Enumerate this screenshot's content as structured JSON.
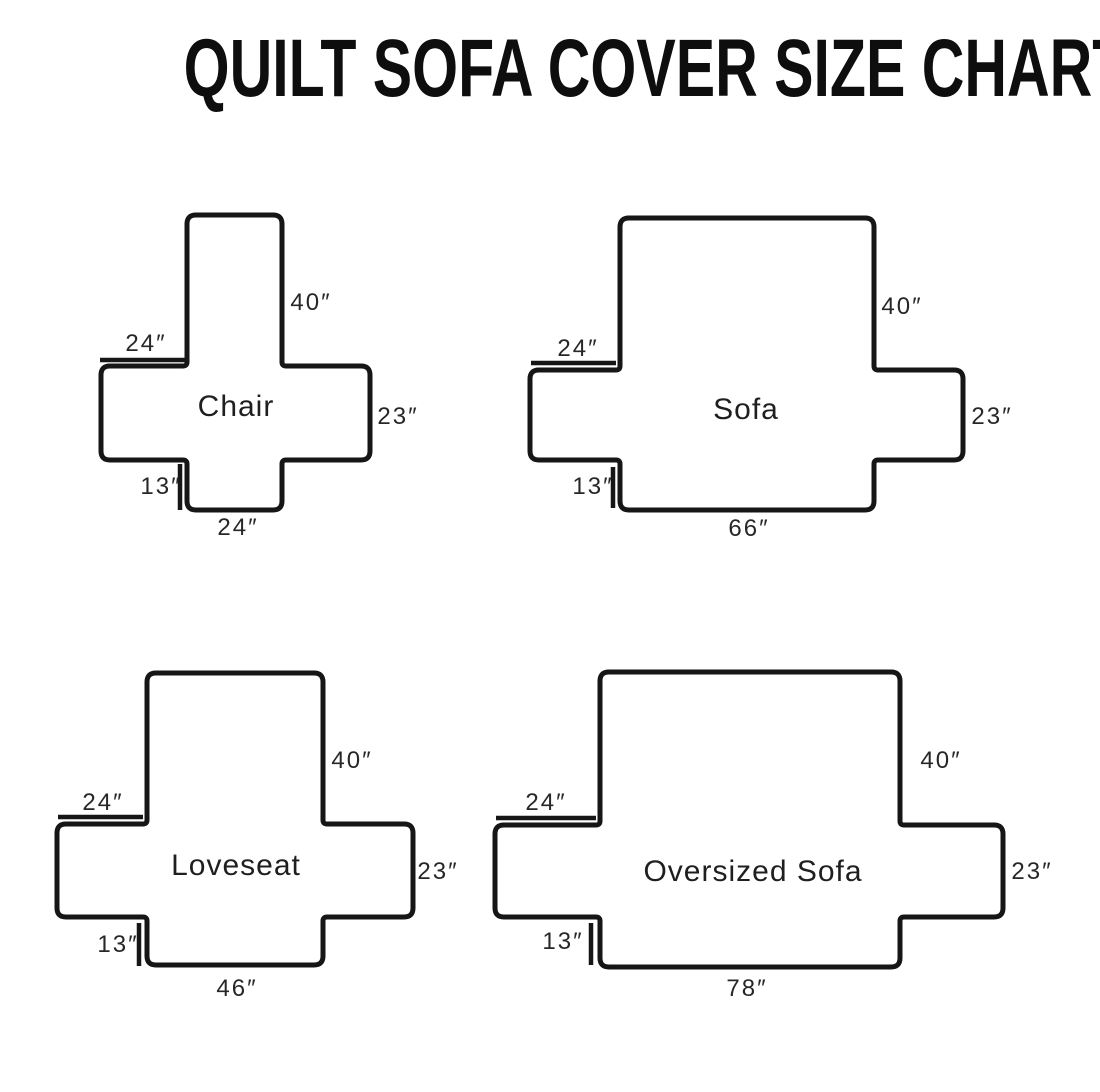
{
  "title": "QUILT SOFA COVER SIZE CHART",
  "colors": {
    "ink": "#161616",
    "label": "#272727",
    "background": "#ffffff"
  },
  "chart_data": {
    "type": "diagram",
    "description": "Cross-shaped quilted sofa cover templates with dimension labels",
    "items": [
      {
        "name": "Chair",
        "back_height_in": 40,
        "arm_width_in": 24,
        "side_height_in": 23,
        "skirt_drop_in": 13,
        "base_width_in": 24
      },
      {
        "name": "Sofa",
        "back_height_in": 40,
        "arm_width_in": 24,
        "side_height_in": 23,
        "skirt_drop_in": 13,
        "base_width_in": 66
      },
      {
        "name": "Loveseat",
        "back_height_in": 40,
        "arm_width_in": 24,
        "side_height_in": 23,
        "skirt_drop_in": 13,
        "base_width_in": 46
      },
      {
        "name": "Oversized Sofa",
        "back_height_in": 40,
        "arm_width_in": 24,
        "side_height_in": 23,
        "skirt_drop_in": 13,
        "base_width_in": 78
      }
    ]
  },
  "diagrams": [
    {
      "name": "Chair",
      "dimensions": {
        "back": "40″",
        "arm": "24″",
        "side": "23″",
        "skirt": "13″",
        "base": "24″"
      },
      "geometry": {
        "v": [
          187,
          215,
          282,
          510
        ],
        "h": [
          101,
          366,
          370,
          460
        ],
        "tick_arm": [
          100,
          360,
          185,
          360
        ],
        "tick_skirt": [
          180,
          464,
          180,
          510
        ]
      },
      "labels": {
        "back": {
          "x": 311,
          "y": 303
        },
        "arm": {
          "x": 146,
          "y": 344
        },
        "name": {
          "x": 236,
          "y": 407
        },
        "side": {
          "x": 398,
          "y": 417
        },
        "skirt": {
          "x": 161,
          "y": 487
        },
        "base": {
          "x": 238,
          "y": 528
        }
      }
    },
    {
      "name": "Sofa",
      "dimensions": {
        "back": "40″",
        "arm": "24″",
        "side": "23″",
        "skirt": "13″",
        "base": "66″"
      },
      "geometry": {
        "v": [
          620,
          218,
          874,
          510
        ],
        "h": [
          530,
          370,
          963,
          460
        ],
        "tick_arm": [
          531,
          363,
          616,
          363
        ],
        "tick_skirt": [
          613,
          467,
          613,
          508
        ]
      },
      "labels": {
        "back": {
          "x": 902,
          "y": 307
        },
        "arm": {
          "x": 578,
          "y": 349
        },
        "name": {
          "x": 746,
          "y": 410
        },
        "side": {
          "x": 992,
          "y": 417
        },
        "skirt": {
          "x": 593,
          "y": 487
        },
        "base": {
          "x": 749,
          "y": 529
        }
      }
    },
    {
      "name": "Loveseat",
      "dimensions": {
        "back": "40″",
        "arm": "24″",
        "side": "23″",
        "skirt": "13″",
        "base": "46″"
      },
      "geometry": {
        "v": [
          147,
          673,
          323,
          965
        ],
        "h": [
          57,
          824,
          413,
          917
        ],
        "tick_arm": [
          58,
          817,
          143,
          817
        ],
        "tick_skirt": [
          139,
          923,
          139,
          966
        ]
      },
      "labels": {
        "back": {
          "x": 352,
          "y": 761
        },
        "arm": {
          "x": 103,
          "y": 803
        },
        "name": {
          "x": 236,
          "y": 866
        },
        "side": {
          "x": 438,
          "y": 872
        },
        "skirt": {
          "x": 118,
          "y": 945
        },
        "base": {
          "x": 237,
          "y": 989
        }
      }
    },
    {
      "name": "Oversized Sofa",
      "dimensions": {
        "back": "40″",
        "arm": "24″",
        "side": "23″",
        "skirt": "13″",
        "base": "78″"
      },
      "geometry": {
        "v": [
          600,
          672,
          900,
          967
        ],
        "h": [
          495,
          825,
          1003,
          917
        ],
        "tick_arm": [
          496,
          818,
          596,
          818
        ],
        "tick_skirt": [
          591,
          923,
          591,
          965
        ]
      },
      "labels": {
        "back": {
          "x": 941,
          "y": 761
        },
        "arm": {
          "x": 546,
          "y": 803
        },
        "name": {
          "x": 753,
          "y": 872
        },
        "side": {
          "x": 1032,
          "y": 872
        },
        "skirt": {
          "x": 563,
          "y": 942
        },
        "base": {
          "x": 747,
          "y": 989
        }
      }
    }
  ]
}
